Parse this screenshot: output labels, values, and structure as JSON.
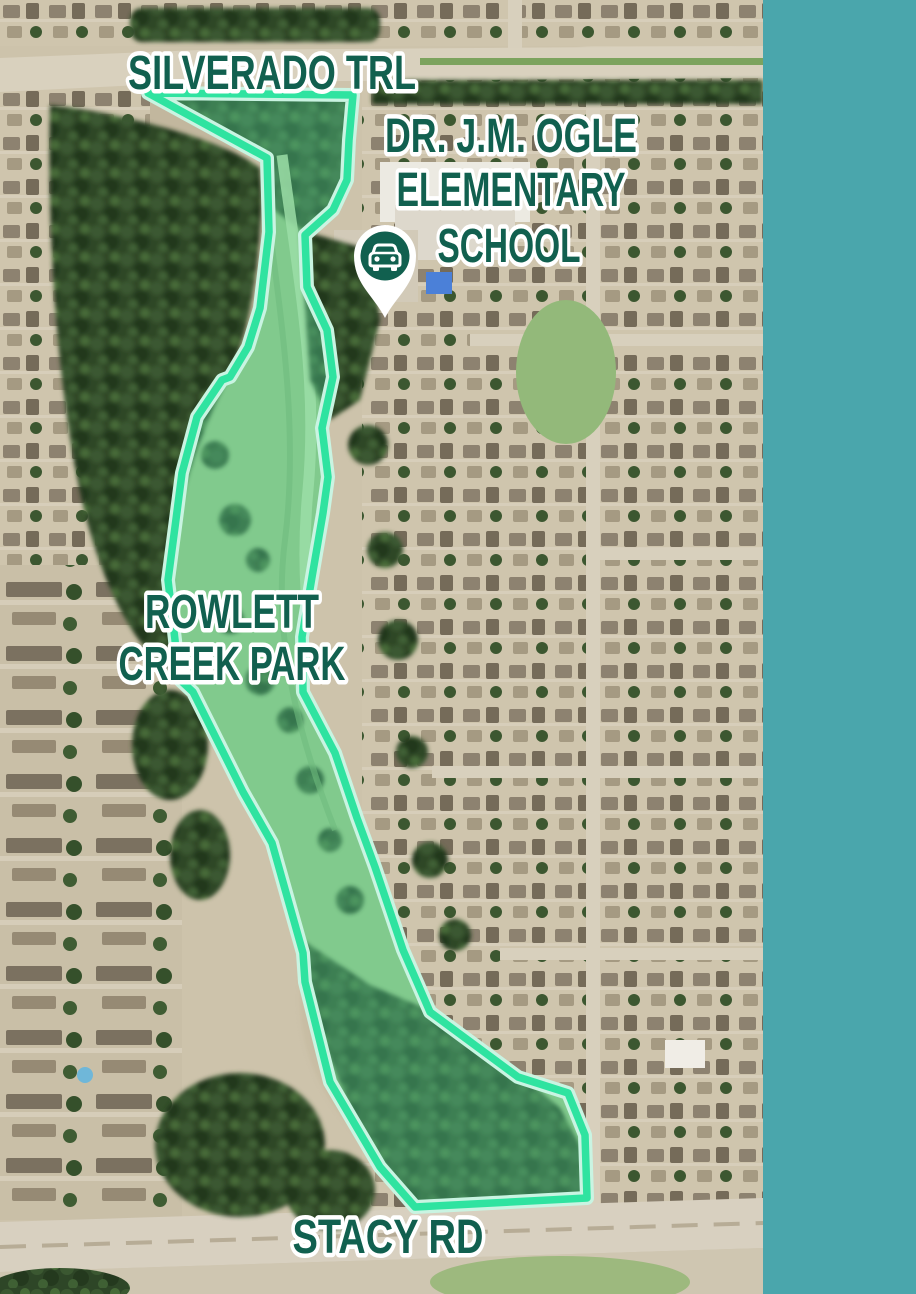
{
  "map": {
    "road_label_top": "SILVERADO TRL",
    "school_label": {
      "line1": "DR. J.M. OGLE",
      "line2": "ELEMENTARY",
      "line3": "SCHOOL"
    },
    "park_label": {
      "line1": "ROWLETT",
      "line2": "CREEK PARK"
    },
    "road_label_bottom": "STACY RD",
    "marker_icon": "car-location-pin",
    "colors": {
      "label_text": "#11604F",
      "label_outline": "#FFFFFF",
      "boundary_stroke": "#2FE3A0",
      "boundary_halo": "#C9F4E2",
      "boundary_fill": "rgba(86,219,158,0.38)",
      "sidebar": "#4AA6AC",
      "pin_fill": "#FFFFFF",
      "pin_inner": "#11604F"
    }
  }
}
